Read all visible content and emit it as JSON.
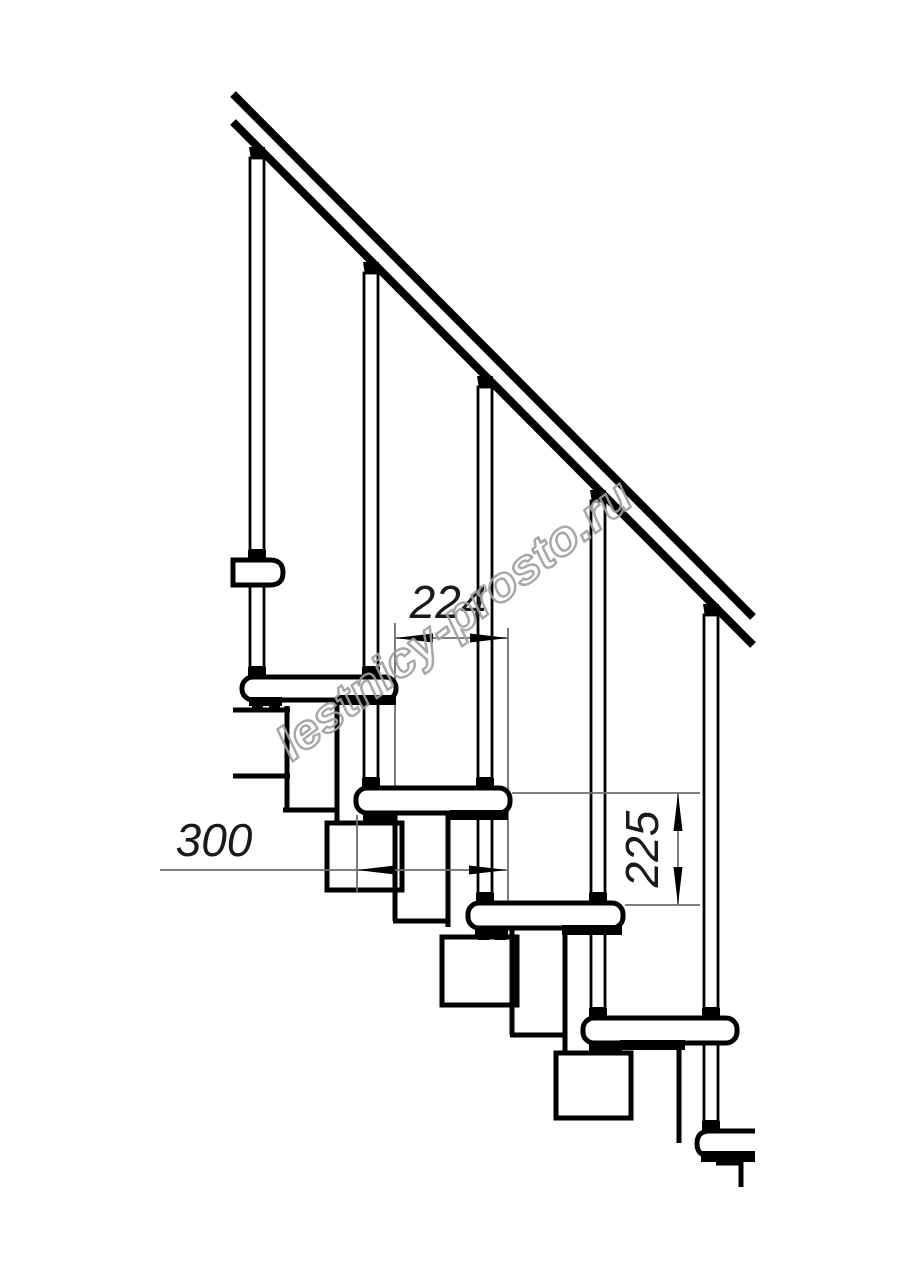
{
  "drawing": {
    "watermark": "lestnicy-prosto.ru",
    "dimensions": {
      "tread_run": "224",
      "tread_depth": "300",
      "step_rise": "225"
    },
    "colors": {
      "line": "#000000",
      "thin_line": "#6e6e6e",
      "dimension_text": "#1a1a1a",
      "watermark": "#9f9f9f",
      "background": "#ffffff"
    }
  }
}
